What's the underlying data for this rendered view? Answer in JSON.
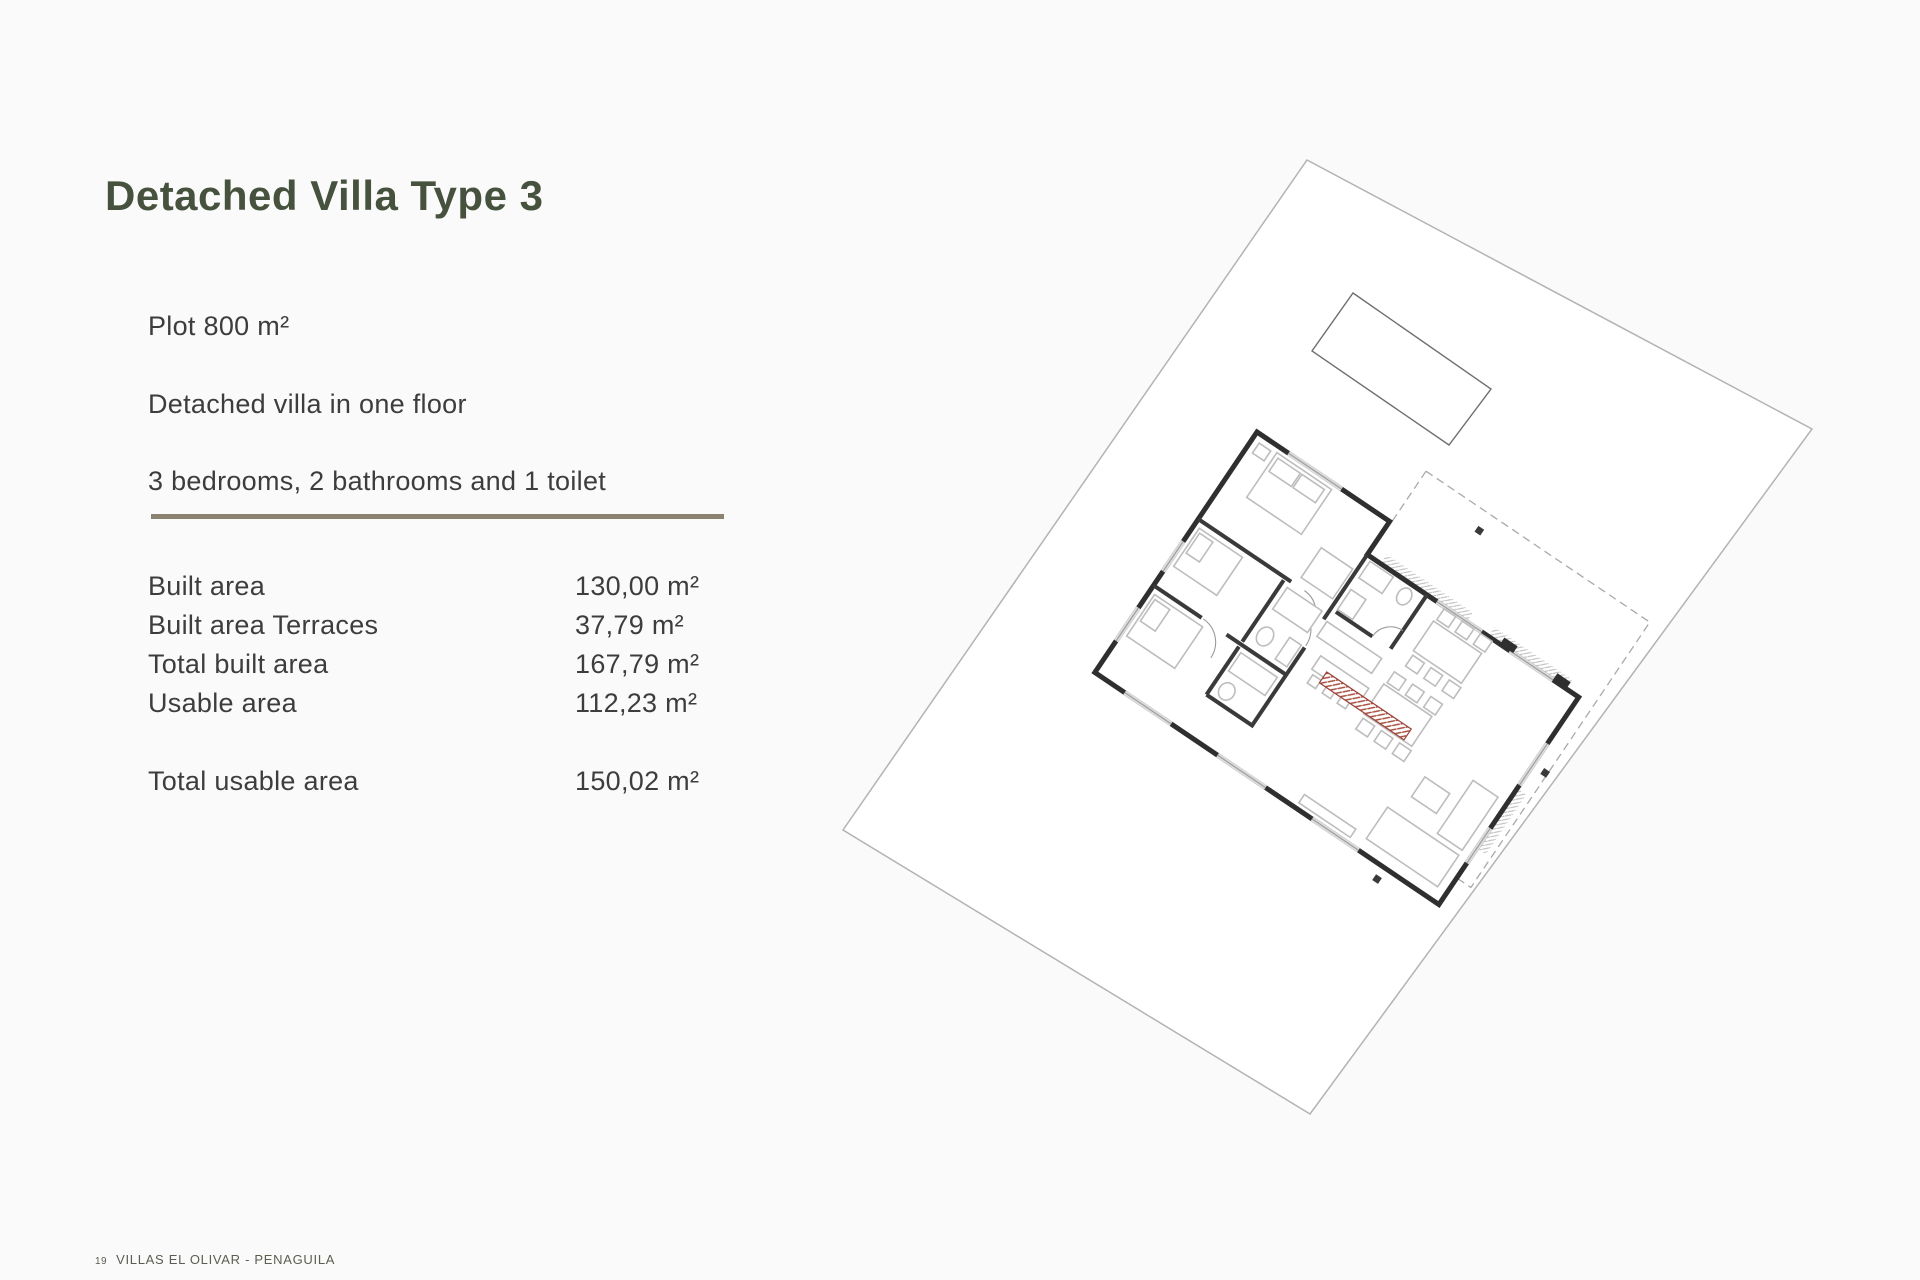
{
  "title": "Detached Villa Type 3",
  "intro": [
    "Plot 800 m²",
    "Detached villa in one floor",
    "3 bedrooms, 2 bathrooms and 1 toilet"
  ],
  "areas": {
    "rows": [
      {
        "label": "Built area",
        "value": "130,00 m²"
      },
      {
        "label": "Built area Terraces",
        "value": "37,79 m²"
      },
      {
        "label": "Total built area",
        "value": "167,79 m²"
      },
      {
        "label": "Usable area",
        "value": "112,23 m²"
      }
    ],
    "total": {
      "label": "Total usable area",
      "value": "150,02 m²"
    }
  },
  "footer": {
    "page_number": "19",
    "project": "VILLAS EL OLIVAR - PENAGUILA"
  },
  "figure": {
    "description_names": [
      "plot-boundary",
      "swimming-pool",
      "villa-floor-plan",
      "terrace-dashed-outline",
      "red-hatched-bench"
    ]
  },
  "colors": {
    "title_green": "#46523d",
    "divider_olive": "#89836f",
    "body_text": "#3d3d3d",
    "wall_dark": "#2f2f2f",
    "red_hatch": "#a84b3d",
    "page_background": "#fafafa"
  }
}
